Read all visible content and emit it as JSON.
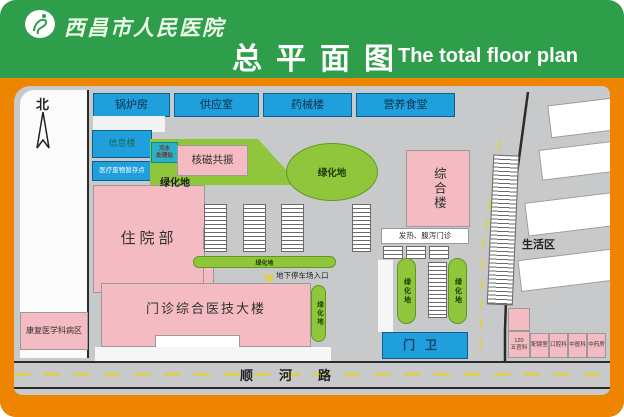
{
  "colors": {
    "header_green": "#2f9e4a",
    "frame_orange": "#ee8500",
    "map_gray": "#c8c9cb",
    "building_pink": "#f4bcc2",
    "building_blue": "#1f9fdc",
    "green_space": "#8fc63c",
    "teal_box": "#26b3c7",
    "road_yellow": "#ddcf52"
  },
  "header": {
    "hospital_name": "西昌市人民医院",
    "title_cn": "总平面图",
    "title_en": "The total floor plan"
  },
  "map": {
    "north": "北",
    "top_row": [
      "锅炉房",
      "供应室",
      "药械楼",
      "营养食堂"
    ],
    "info_building": "信息楼",
    "medical_waste": "医疗废物暂存点",
    "sewage_line1": "污水",
    "sewage_line2": "处理站",
    "mri": "核磁共振",
    "green_label": "绿化地",
    "inpatient": "住院部",
    "complex": "综合楼",
    "fever_clinic": "发热、腹泻门诊",
    "gate": "门卫",
    "outpatient": "门诊综合医技大楼",
    "rehab_ward": "康复医学科病区",
    "living_area": "生活区",
    "underground_parking": "地下停车场入口",
    "road_south": "顺河路",
    "er_line1": "120",
    "er_line2": "五官科",
    "shops": [
      "配镜室",
      "口腔科",
      "中医科",
      "中药房"
    ]
  }
}
